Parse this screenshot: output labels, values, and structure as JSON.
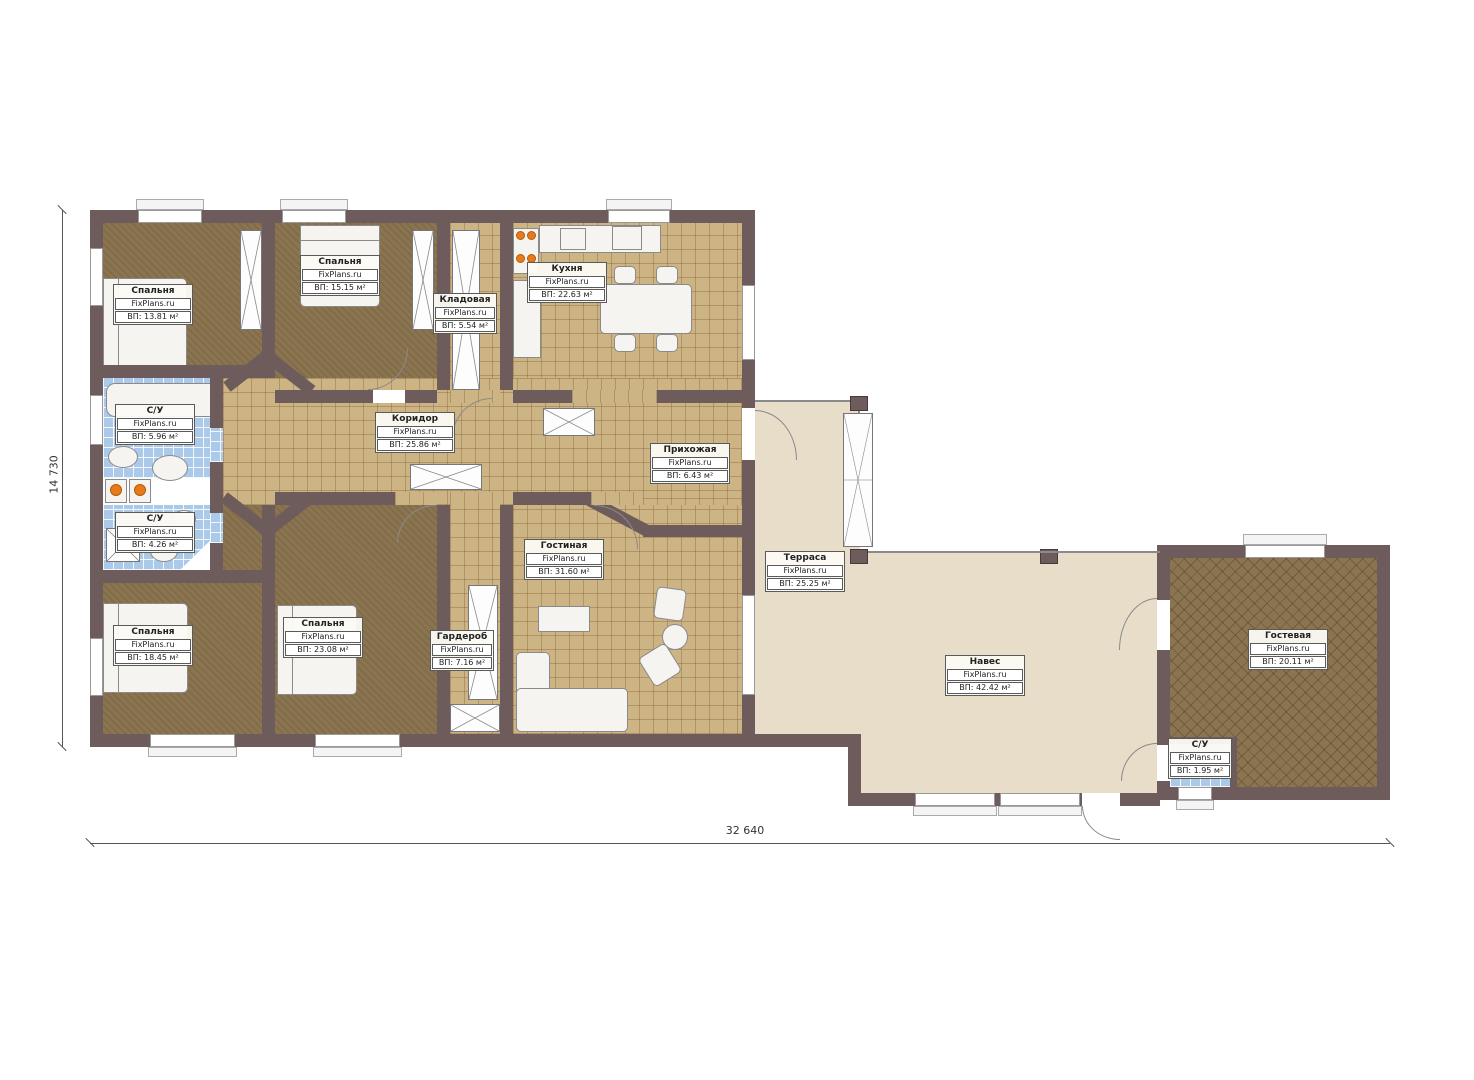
{
  "brand": "FixPlans.ru",
  "rooms": [
    {
      "name": "Спальня",
      "area": "ВП: 13.81 м²"
    },
    {
      "name": "Спальня",
      "area": "ВП: 15.15 м²"
    },
    {
      "name": "Кладовая",
      "area": "ВП: 5.54 м²"
    },
    {
      "name": "Кухня",
      "area": "ВП: 22.63 м²"
    },
    {
      "name": "С/У",
      "area": "ВП: 5.96 м²"
    },
    {
      "name": "С/У",
      "area": "ВП: 4.26 м²"
    },
    {
      "name": "Коридор",
      "area": "ВП: 25.86 м²"
    },
    {
      "name": "Прихожая",
      "area": "ВП: 6.43 м²"
    },
    {
      "name": "Гостиная",
      "area": "ВП: 31.60 м²"
    },
    {
      "name": "Спальня",
      "area": "ВП: 18.45 м²"
    },
    {
      "name": "Спальня",
      "area": "ВП: 23.08 м²"
    },
    {
      "name": "Гардероб",
      "area": "ВП: 7.16 м²"
    },
    {
      "name": "Терраса",
      "area": "ВП: 25.25 м²"
    },
    {
      "name": "Навес",
      "area": "ВП: 42.42 м²"
    },
    {
      "name": "Гостевая",
      "area": "ВП: 20.11 м²"
    },
    {
      "name": "С/У",
      "area": "ВП: 1.95 м²"
    }
  ],
  "dimensions": {
    "height": "14 730",
    "width": "32 640"
  },
  "colors": {
    "wall": "#6e5c5c",
    "tile": "#ccb485",
    "carpet": "#8b7450",
    "bath": "#abc9e9",
    "terrace": "#e7ddc9",
    "burner": "#e87a1e"
  }
}
